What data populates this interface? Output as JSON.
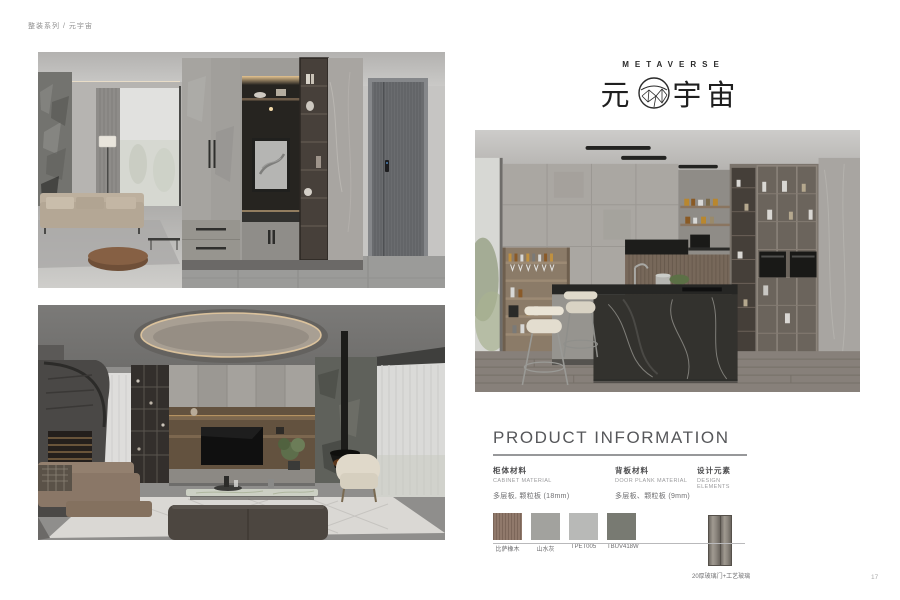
{
  "page": {
    "breadcrumb": "整装系列 / 元宇宙",
    "page_number": "17"
  },
  "logo": {
    "en": "METAVERSE",
    "zh_left": "元",
    "zh_right": "宇宙"
  },
  "product_info": {
    "title": "PRODUCT INFORMATION",
    "sections": [
      {
        "title_zh": "柜体材料",
        "title_en": "CABINET MATERIAL",
        "value": "多层板, 颗粒板 (18mm)"
      },
      {
        "title_zh": "背板材料",
        "title_en": "DOOR PLANK MATERIAL",
        "value": "多层板、颗粒板 (9mm)"
      },
      {
        "title_zh": "设计元素",
        "title_en": "DESIGN ELEMENTS"
      }
    ],
    "swatches": [
      {
        "label": "比萨橡木",
        "color": "#8a7263"
      },
      {
        "label": "山水灰",
        "color": "#a2a29e"
      },
      {
        "label": "TPET005",
        "color": "#b8b9b7"
      },
      {
        "label": "TBUV418W",
        "color": "#787a72"
      }
    ],
    "design_element": {
      "label": "20厚玻璃门+工艺玻璃",
      "color": "#8e8880"
    }
  }
}
